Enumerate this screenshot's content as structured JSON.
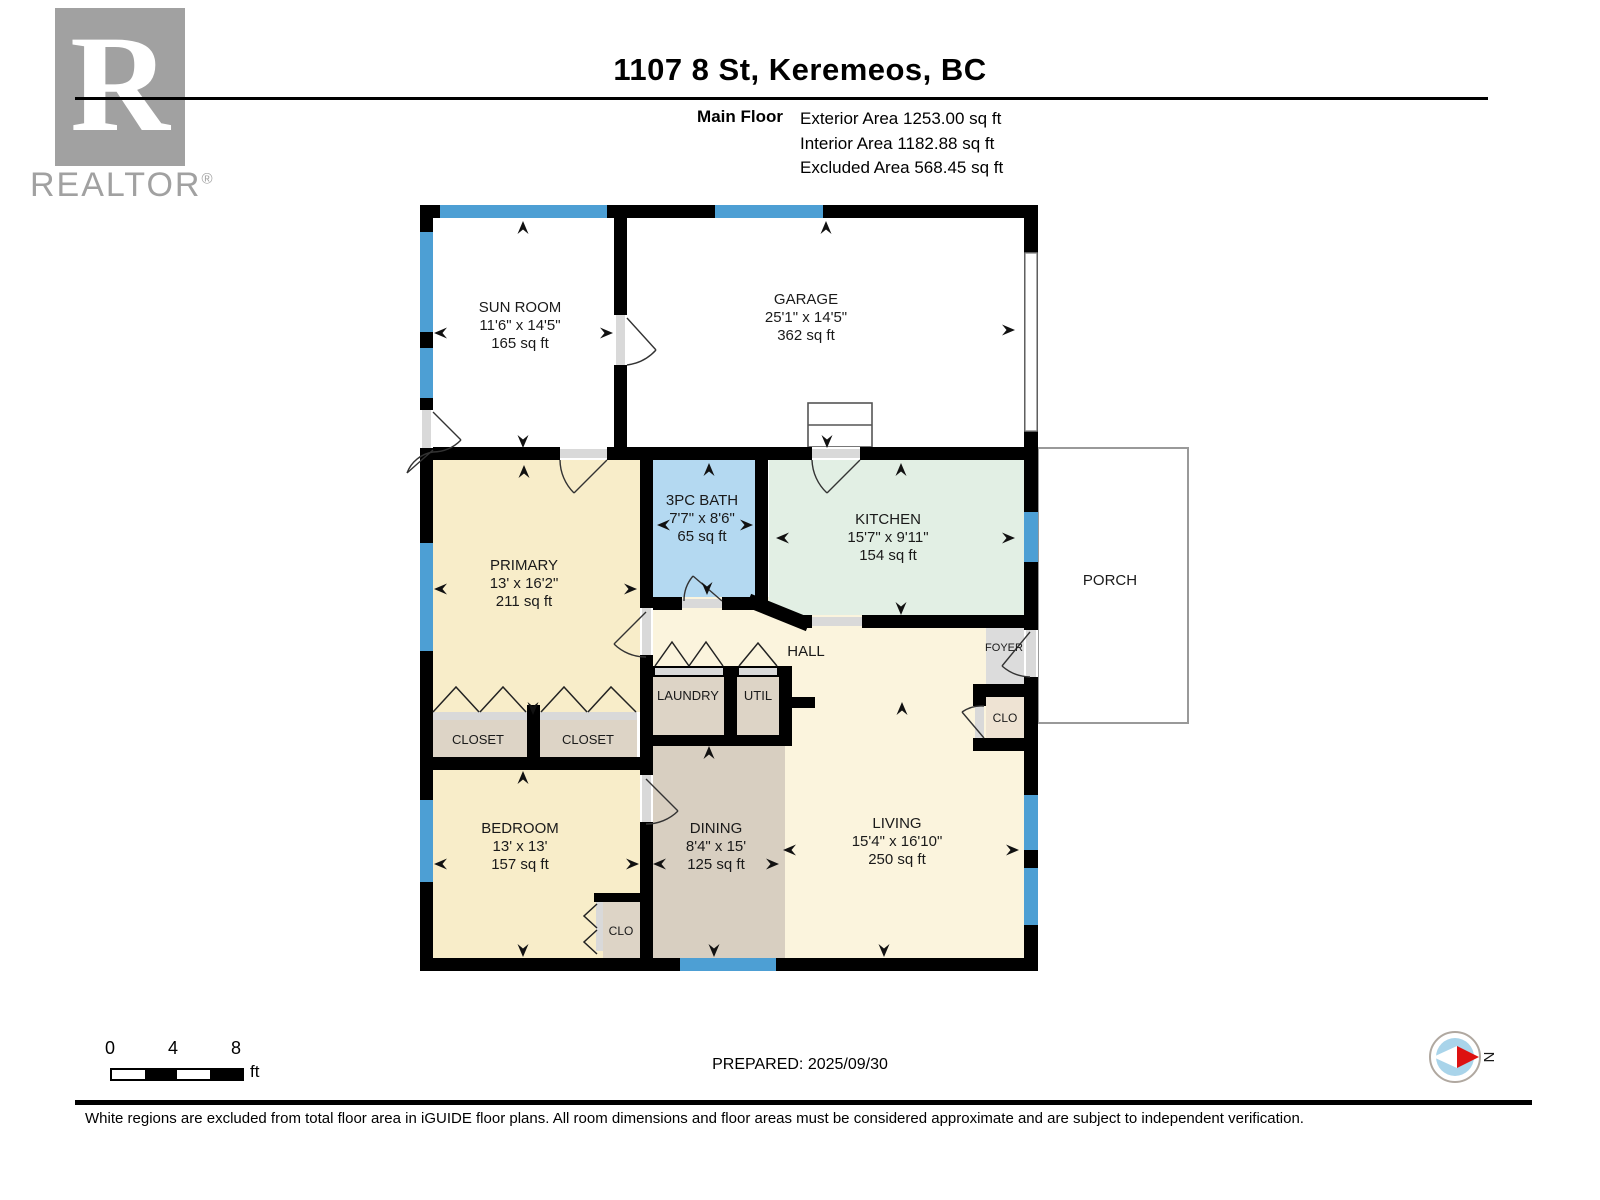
{
  "header": {
    "logo": {
      "letter": "R",
      "brand": "REALTOR",
      "registered": "®"
    },
    "title": "1107 8 St, Keremeos, BC",
    "floor_label": "Main Floor",
    "area_lines": [
      "Exterior Area 1253.00 sq ft",
      "Interior Area 1182.88 sq ft",
      "Excluded Area 568.45 sq ft"
    ]
  },
  "rooms": [
    {
      "id": "sun-room",
      "name": "SUN ROOM",
      "dims": "11'6\" x 14'5\"",
      "area": "165 sq ft"
    },
    {
      "id": "garage",
      "name": "GARAGE",
      "dims": "25'1\" x 14'5\"",
      "area": "362 sq ft"
    },
    {
      "id": "bath",
      "name": "3PC BATH",
      "dims": "7'7\" x 8'6\"",
      "area": "65 sq ft"
    },
    {
      "id": "kitchen",
      "name": "KITCHEN",
      "dims": "15'7\" x 9'11\"",
      "area": "154 sq ft"
    },
    {
      "id": "primary",
      "name": "PRIMARY",
      "dims": "13' x 16'2\"",
      "area": "211 sq ft"
    },
    {
      "id": "porch",
      "name": "PORCH"
    },
    {
      "id": "hall",
      "name": "HALL"
    },
    {
      "id": "laundry",
      "name": "LAUNDRY"
    },
    {
      "id": "util",
      "name": "UTIL"
    },
    {
      "id": "foyer",
      "name": "FOYER"
    },
    {
      "id": "clo-foyer",
      "name": "CLO"
    },
    {
      "id": "closet-left",
      "name": "CLOSET"
    },
    {
      "id": "closet-right",
      "name": "CLOSET"
    },
    {
      "id": "bedroom",
      "name": "BEDROOM",
      "dims": "13' x 13'",
      "area": "157 sq ft"
    },
    {
      "id": "dining",
      "name": "DINING",
      "dims": "8'4\" x 15'",
      "area": "125 sq ft"
    },
    {
      "id": "living",
      "name": "LIVING",
      "dims": "15'4\" x 16'10\"",
      "area": "250 sq ft"
    },
    {
      "id": "clo-bedroom",
      "name": "CLO"
    }
  ],
  "footer": {
    "scale_ticks": [
      "0",
      "4",
      "8"
    ],
    "scale_unit": "ft",
    "prepared": "PREPARED: 2025/09/30",
    "compass_label": "N",
    "disclaimer": "White regions are excluded from total floor area in iGUIDE floor plans. All room dimensions and floor areas must be considered approximate and are subject to independent verification."
  },
  "colors": {
    "wall": "#000000",
    "window_blue": "#4d9fd4",
    "bath_blue": "#b4d9f1",
    "kitchen_green": "#e2efe4",
    "bedroom_cream": "#f8edc9",
    "living_cream": "#fbf4dd",
    "dining_tan": "#d8cfc1",
    "closet_tan": "#ddd4c6",
    "foyer_gray": "#dcdcdc",
    "logo_gray": "#a1a1a1",
    "compass_blue": "#a9d4ea",
    "compass_red": "#dd1111"
  }
}
